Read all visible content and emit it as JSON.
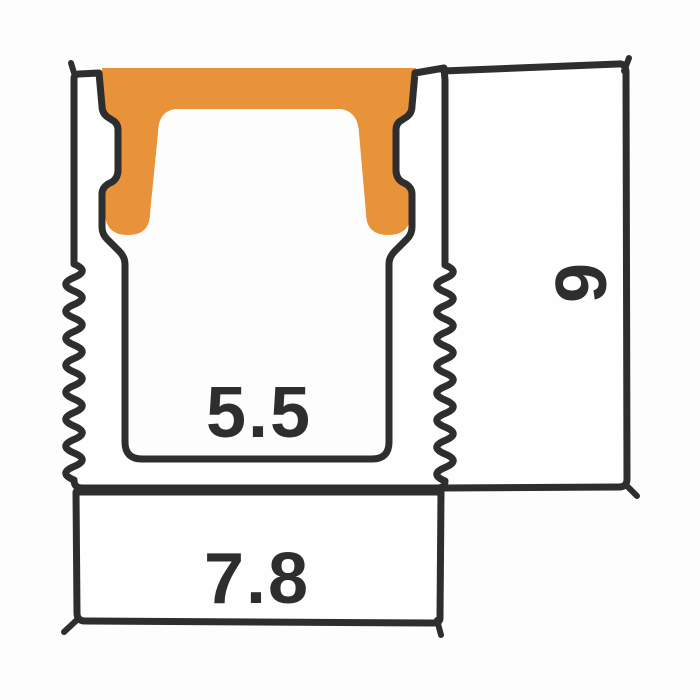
{
  "diagram": {
    "kind": "led-profile-cross-section",
    "dimensions": {
      "inner_width": "5.5",
      "base_width": "7.8",
      "height": "9"
    },
    "colors": {
      "outline": "#2e2e2e",
      "cover": "#e8923a",
      "label": "#2e2e2e",
      "surface": "#fefefe"
    }
  }
}
